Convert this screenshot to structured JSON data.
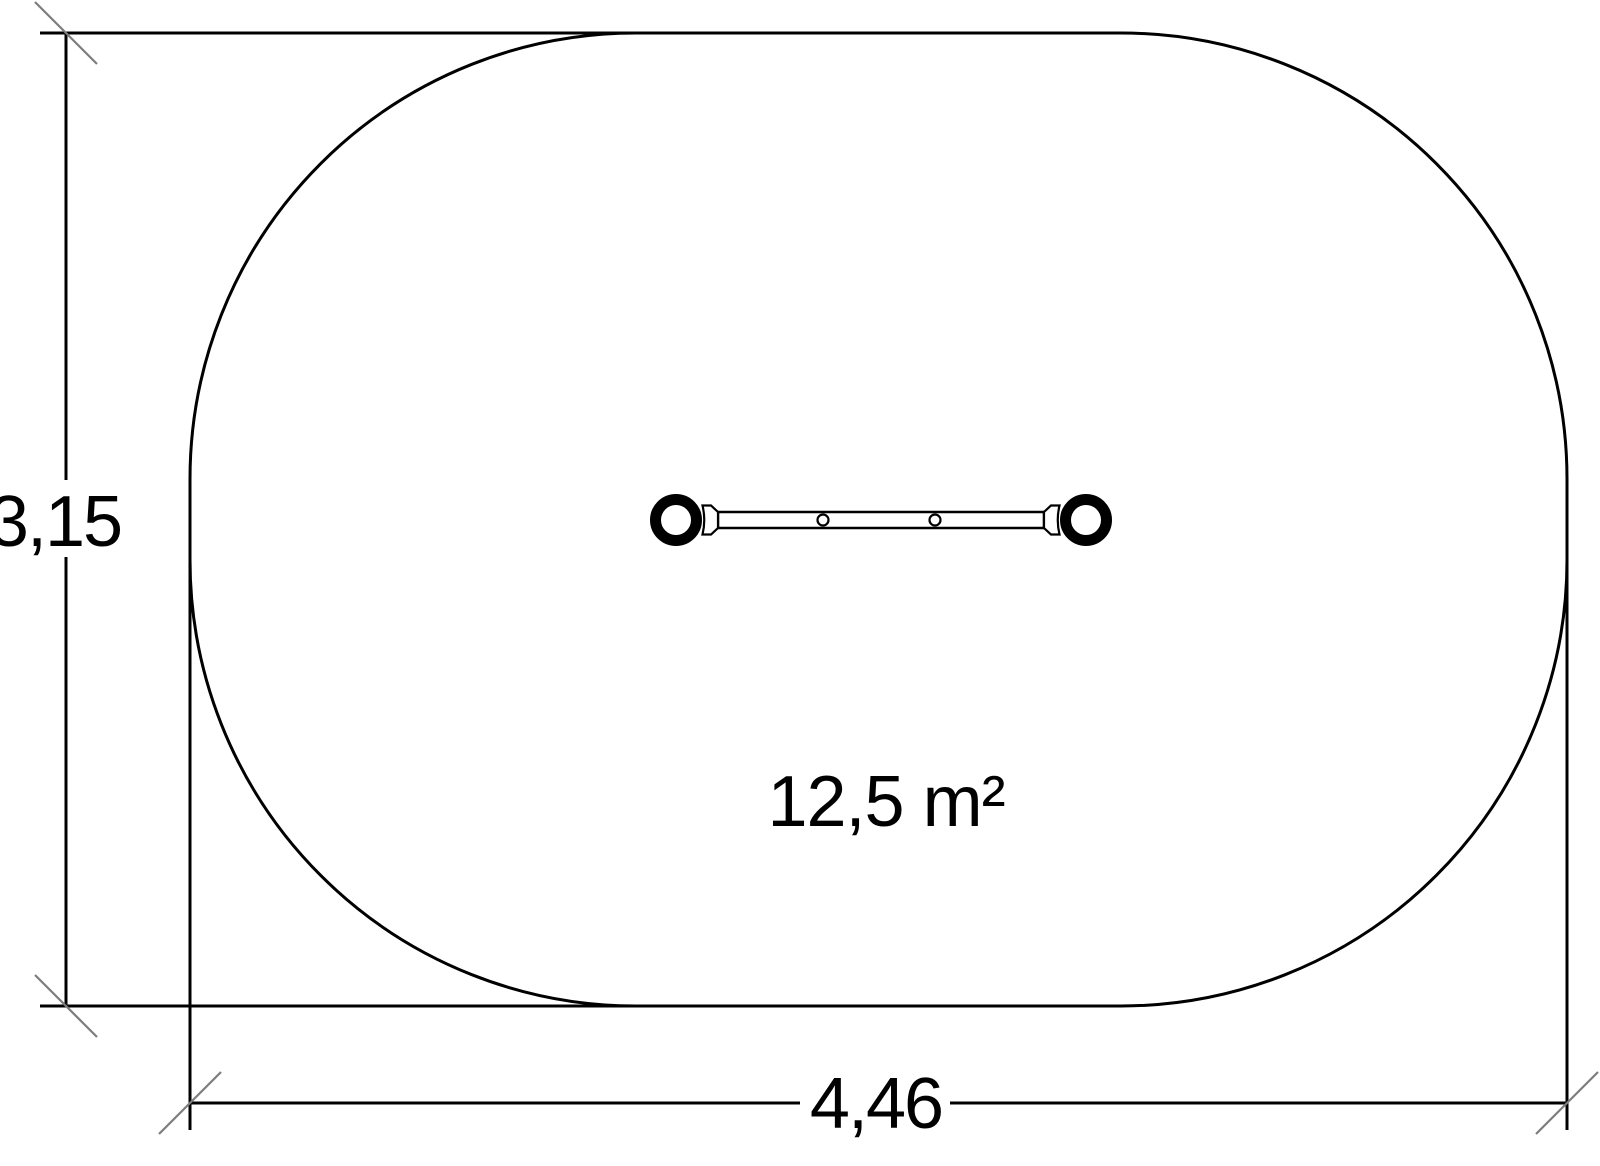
{
  "drawing": {
    "type": "safety-zone-plan",
    "dimensions": {
      "height_label": "3,15",
      "width_label": "4,46"
    },
    "area_label": "12,5 m²",
    "colors": {
      "line": "#000000",
      "tick": "#7d7d7d",
      "background": "#ffffff"
    }
  }
}
